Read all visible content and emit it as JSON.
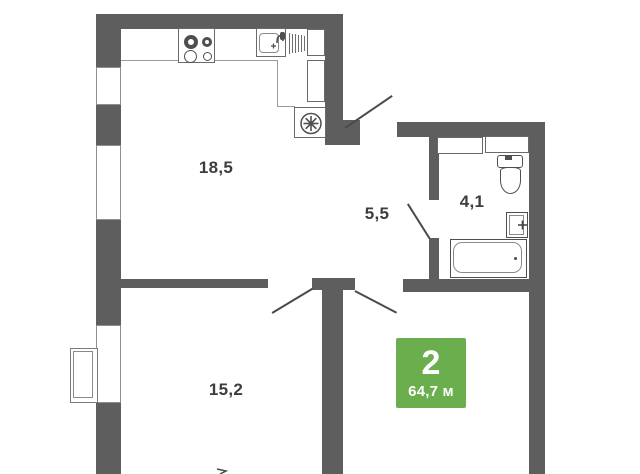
{
  "plan": {
    "type": "apartment-floor-plan",
    "rooms": [
      {
        "id": "kitchen-living",
        "area": "18,5"
      },
      {
        "id": "hallway",
        "area": "5,5"
      },
      {
        "id": "bathroom",
        "area": "4,1"
      },
      {
        "id": "bedroom",
        "area": "15,2"
      }
    ],
    "badge": {
      "rooms_count": "2",
      "total_area": "64,7 м"
    },
    "colors": {
      "wall": "#5e5e5e",
      "thin_line": "#9a9a9a",
      "fixture_line": "#4f4f4f",
      "label_text": "#3d3d3d",
      "badge_green": "#6bae4e",
      "badge_text": "#ffffff"
    },
    "icons": [
      "stove-icon",
      "kitchen-sink-icon",
      "dish-rack-icon",
      "vent-fan-icon",
      "toilet-icon",
      "washbasin-icon",
      "bathtub-icon",
      "window",
      "balcony-bay",
      "door-swing"
    ]
  }
}
